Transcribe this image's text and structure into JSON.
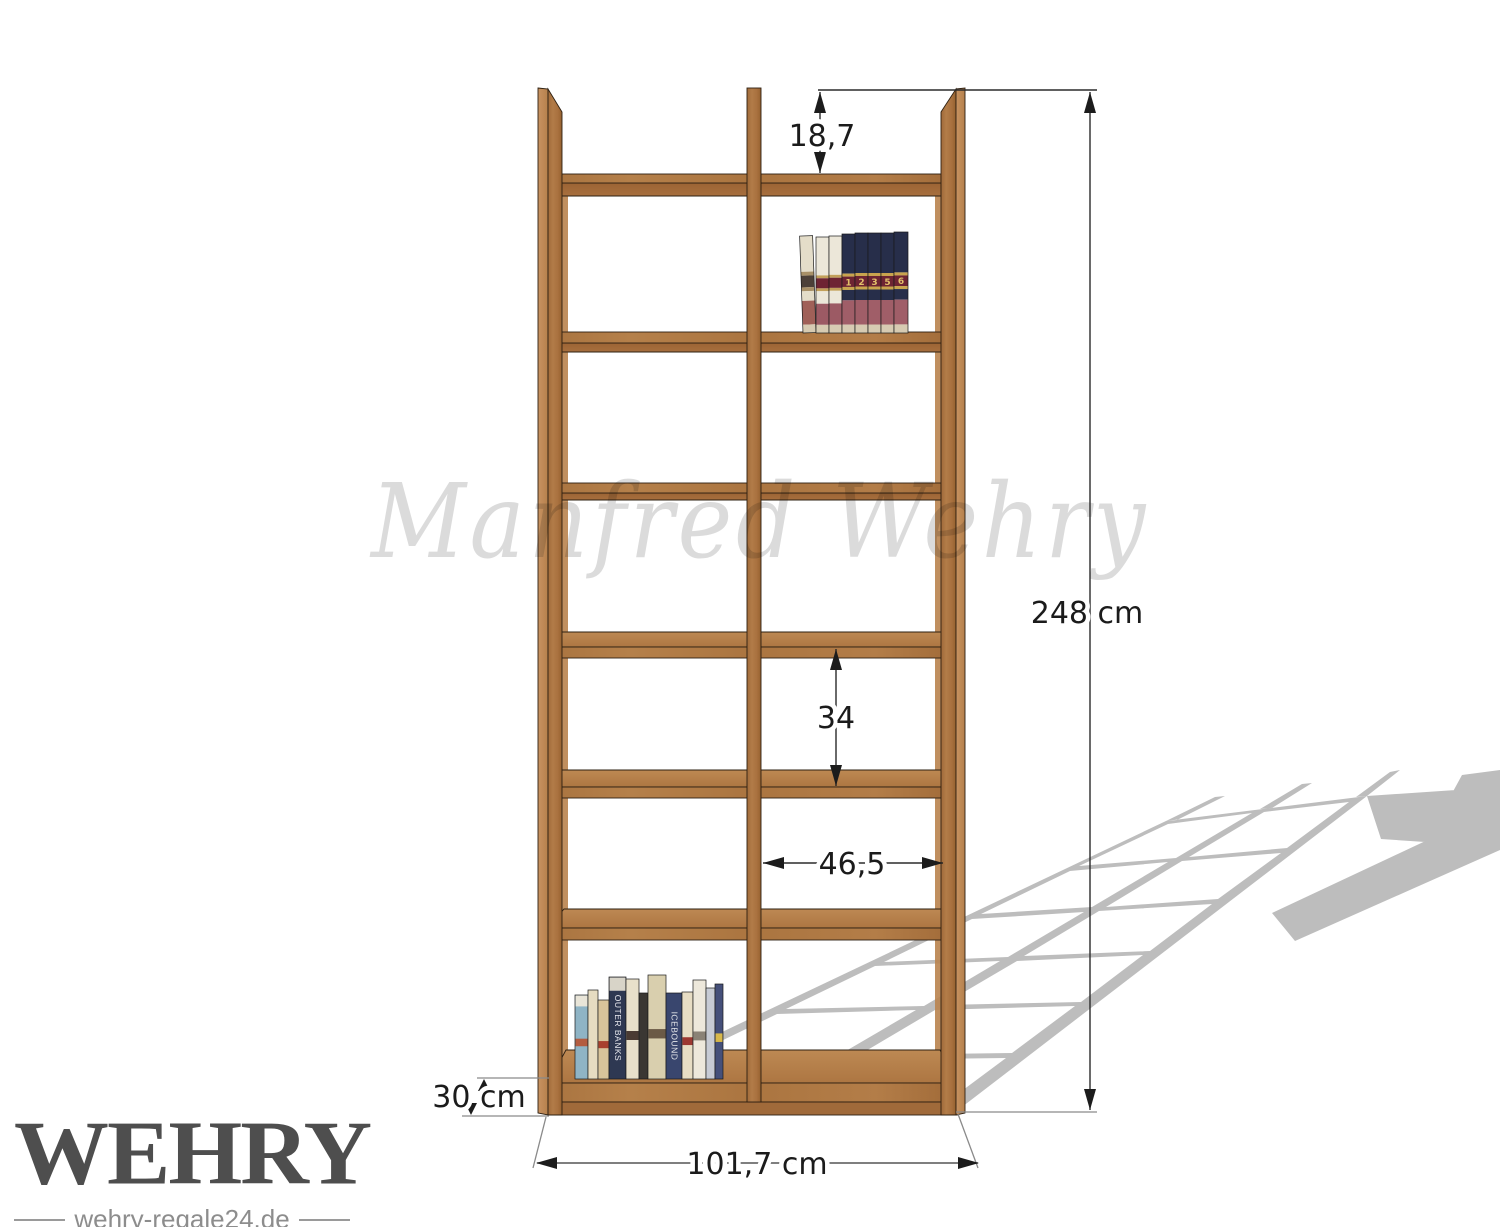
{
  "meta": {
    "watermark": "Manfred Wehry",
    "brand": "WEHRY",
    "brand_tagline": "wehry-regale24.de"
  },
  "illustration": {
    "type": "bookshelf technical drawing",
    "units": "cm",
    "columns": 2,
    "shelf_rows": 7
  },
  "dimensions": {
    "top_clearance": "18,7",
    "total_height": "248 cm",
    "compartment_height": "34",
    "compartment_width": "46,5",
    "depth": "30 cm",
    "total_width": "101,7 cm"
  },
  "colors": {
    "wood_front": "#ad7644",
    "wood_side": "#c28c59",
    "wood_top": "#b8824d",
    "wood_under": "#9f6838",
    "floor_shadow": "#bdbdbd",
    "dimension_line": "#2b2b2b",
    "dimension_text": "#1b1b1b",
    "brand_text": "#4e4e4e",
    "tagline_text": "#8d8d8d",
    "watermark_gray": "#d5d5d5"
  },
  "scene": {
    "top_books": {
      "x": 803,
      "shelf_y": 333,
      "volumes": [
        {
          "w": 13,
          "h": 97,
          "style": "cream",
          "lean": -2,
          "num": ""
        },
        {
          "w": 13,
          "h": 96,
          "style": "white",
          "num": ""
        },
        {
          "w": 13,
          "h": 97,
          "style": "white",
          "num": ""
        },
        {
          "w": 13,
          "h": 99,
          "style": "navy",
          "num": "1"
        },
        {
          "w": 13,
          "h": 100,
          "style": "navy",
          "num": "2"
        },
        {
          "w": 13,
          "h": 100,
          "style": "navy",
          "num": "3"
        },
        {
          "w": 13,
          "h": 100,
          "style": "navy",
          "num": "5"
        },
        {
          "w": 14,
          "h": 101,
          "style": "navy",
          "num": "6"
        }
      ]
    },
    "bottom_books": {
      "shelf_y": 1079,
      "books": [
        {
          "x": 575,
          "w": 13,
          "h": 84,
          "c": "#8fb4c5",
          "top": "#e9e5d8",
          "accent": "#b35c40"
        },
        {
          "x": 588,
          "w": 10,
          "h": 89,
          "c": "#e6dcc1"
        },
        {
          "x": 598,
          "w": 11,
          "h": 79,
          "c": "#d8c49a",
          "accent": "#a8402e"
        },
        {
          "x": 609,
          "w": 17,
          "h": 102,
          "c": "#2e3852",
          "top": "#d8d4c8",
          "label": "OUTER BANKS",
          "lc": "#e8e8ee"
        },
        {
          "x": 626,
          "w": 13,
          "h": 100,
          "c": "#e8e0ca",
          "accent": "#4a3b33"
        },
        {
          "x": 639,
          "w": 9,
          "h": 86,
          "c": "#3a3733"
        },
        {
          "x": 648,
          "w": 18,
          "h": 104,
          "c": "#d9cfae",
          "accent": "#6b5a46"
        },
        {
          "x": 666,
          "w": 16,
          "h": 86,
          "c": "#39466e",
          "label": "ICEBOUND",
          "lc": "#e4e6ea"
        },
        {
          "x": 682,
          "w": 11,
          "h": 87,
          "c": "#e7ddc4",
          "accent": "#9c3832"
        },
        {
          "x": 693,
          "w": 13,
          "h": 99,
          "c": "#ede8db",
          "accent": "#8a8276"
        },
        {
          "x": 706,
          "w": 9,
          "h": 91,
          "c": "#c7cbd4"
        },
        {
          "x": 715,
          "w": 8,
          "h": 95,
          "c": "#45507a",
          "accent": "#d8b84a"
        }
      ]
    }
  }
}
